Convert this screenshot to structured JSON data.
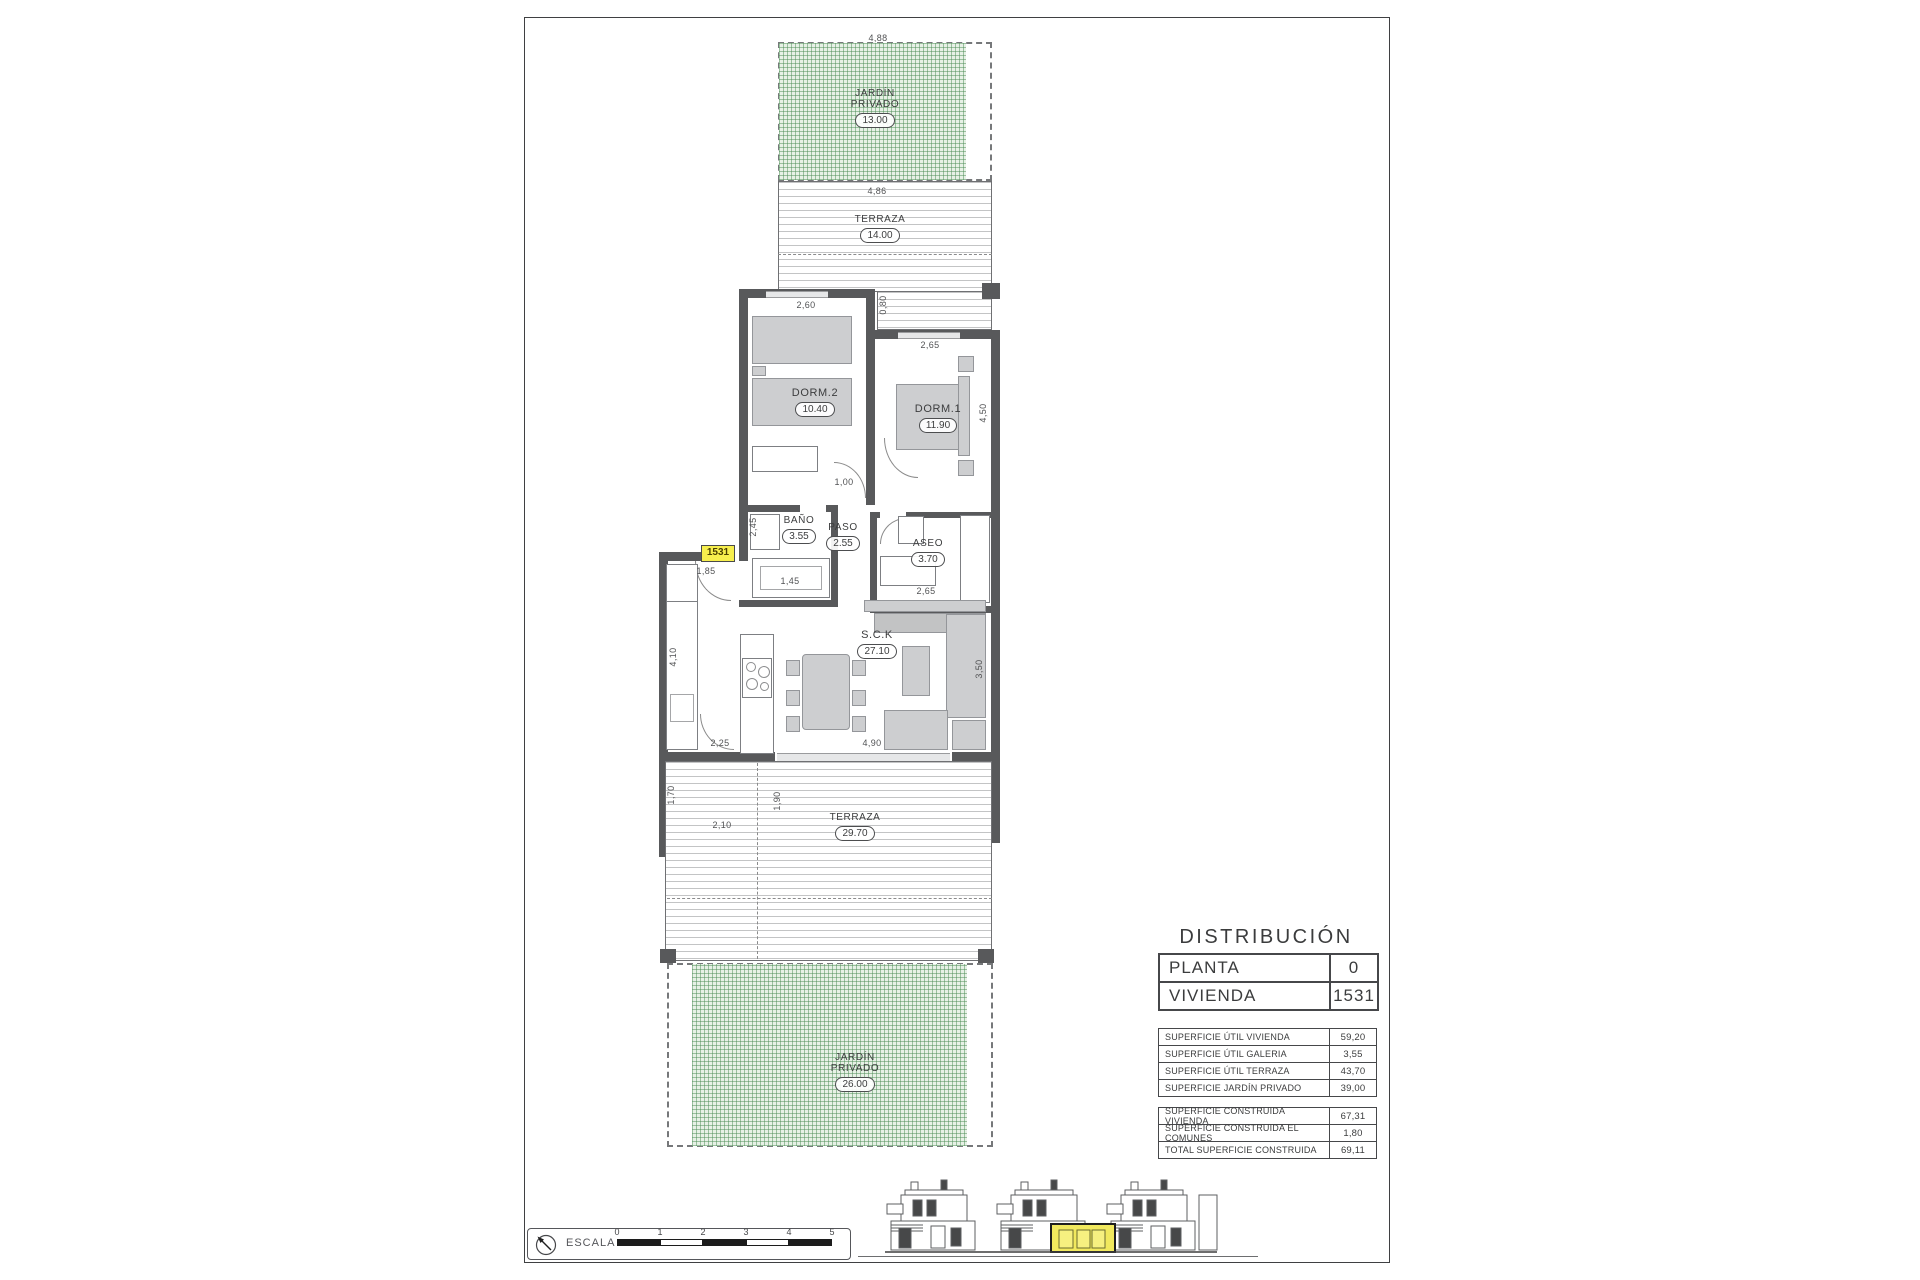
{
  "plan": {
    "unit_badge": "1531",
    "rooms": {
      "jardin_top": {
        "name": "JARDÍN PRIVADO",
        "area": "13.00"
      },
      "terraza_top": {
        "name": "TERRAZA",
        "area": "14.00"
      },
      "dorm2": {
        "name": "DORM.2",
        "area": "10.40"
      },
      "dorm1": {
        "name": "DORM.1",
        "area": "11.90"
      },
      "bano": {
        "name": "BAÑO",
        "area": "3.55"
      },
      "paso": {
        "name": "PASO",
        "area": "2.55"
      },
      "aseo": {
        "name": "ASEO",
        "area": "3.70"
      },
      "sck": {
        "name": "S.C.K",
        "area": "27.10"
      },
      "galeria": {
        "name": "GALERIA",
        "area": "3.55"
      },
      "terraza_bottom": {
        "name": "TERRAZA",
        "area": "29.70"
      },
      "jardin_bottom": {
        "name": "JARDÍN PRIVADO",
        "area": "26.00"
      }
    },
    "dims": {
      "garden_top_width": "4,88",
      "terraza_top_width": "4,86",
      "dorm2_width": "2,60",
      "terraza_step": "0,80",
      "dorm1_width": "2,65",
      "dorm1_depth": "4,50",
      "paso_width": "1,00",
      "bano_depth": "2,45",
      "entry_width": "1,85",
      "bano_width": "1,45",
      "aseo_width": "2,65",
      "kitchen_depth": "4,10",
      "salon_depth": "3,50",
      "kitchen_pass": "2,25",
      "salon_width": "4,90",
      "galeria_depth": "1,70",
      "galeria_width": "2,10",
      "terraza_edge": "1,90"
    }
  },
  "panel": {
    "title": "DISTRIBUCIÓN",
    "unit_table": {
      "rows": [
        {
          "label": "PLANTA",
          "value": "0"
        },
        {
          "label": "VIVIENDA",
          "value": "1531"
        }
      ]
    },
    "useful_table": {
      "rows": [
        {
          "label": "SUPERFICIE ÚTIL VIVIENDA",
          "value": "59,20"
        },
        {
          "label": "SUPERFICIE ÚTIL GALERIA",
          "value": "3,55"
        },
        {
          "label": "SUPERFICIE ÚTIL TERRAZA",
          "value": "43,70"
        },
        {
          "label": "SUPERFICIE JARDÍN PRIVADO",
          "value": "39,00"
        }
      ]
    },
    "built_table": {
      "rows": [
        {
          "label": "SUPERFICIE CONSTRUIDA VIVIENDA",
          "value": "67,31"
        },
        {
          "label": "SUPERFICIE CONSTRUIDA EL COMUNES",
          "value": "1,80"
        },
        {
          "label": "TOTAL SUPERFICIE CONSTRUIDA",
          "value": "69,11"
        }
      ]
    }
  },
  "scale_bar": {
    "label": "ESCALA :",
    "ticks": [
      "0",
      "1",
      "2",
      "3",
      "4",
      "5"
    ]
  },
  "colors": {
    "garden_green": "#5a8e56",
    "wall_gray": "#58595b",
    "highlight_yellow": "#f1e95e",
    "badge_yellow": "#f7ef4d"
  }
}
